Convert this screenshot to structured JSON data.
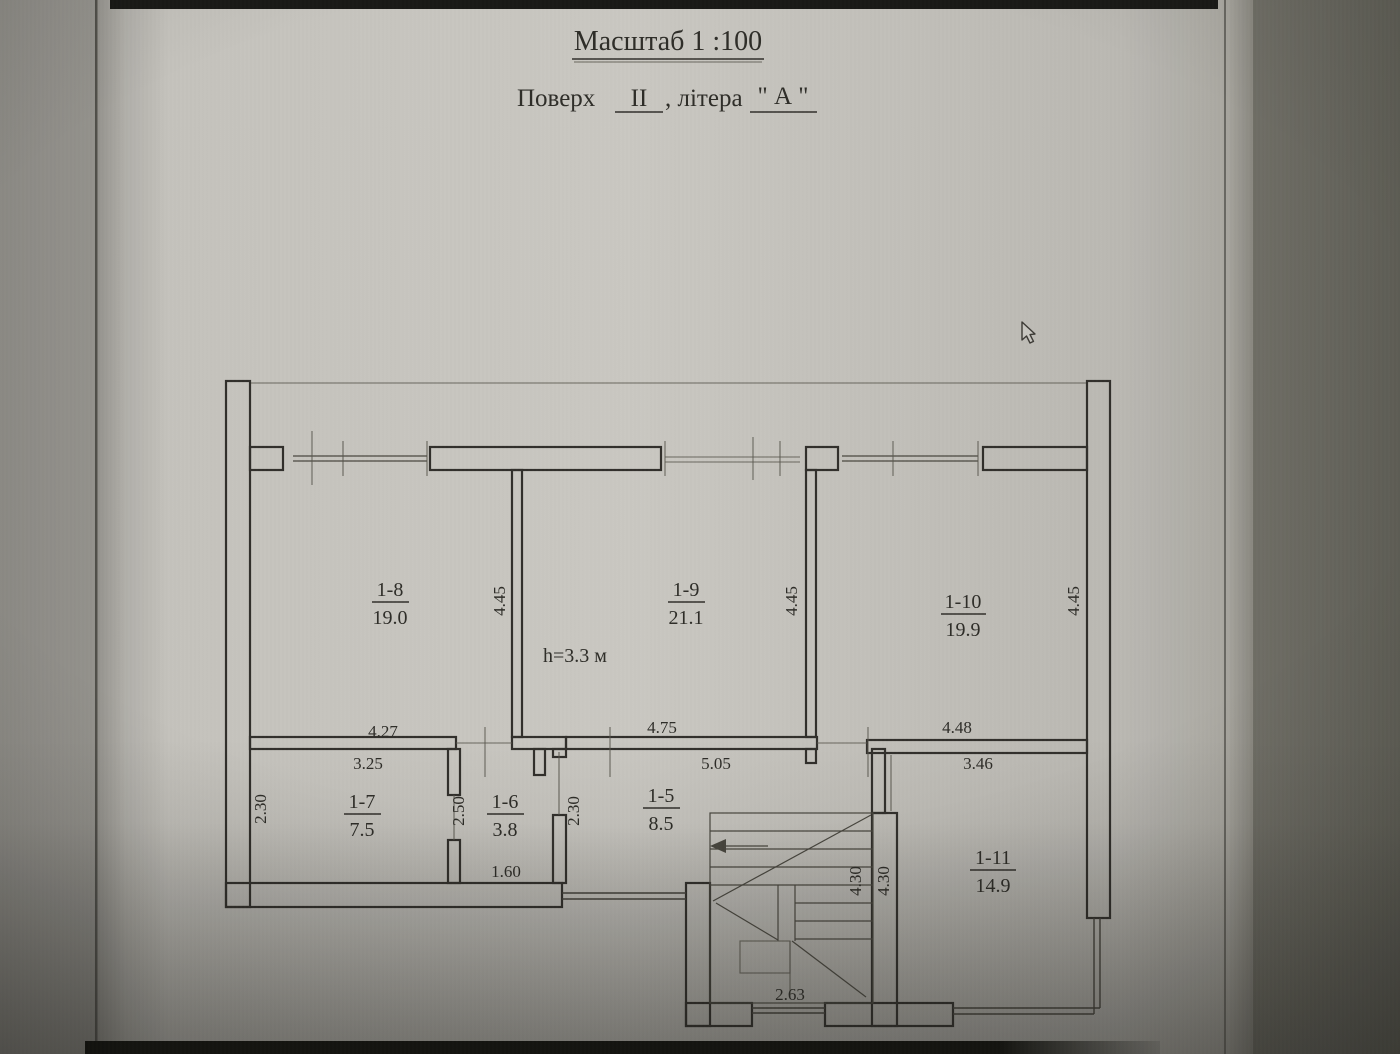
{
  "header": {
    "title": "Масштаб 1 :100",
    "floor_label": "Поверх",
    "floor_value": "ІІ",
    "separator": ", літера",
    "letter_value": "\" А \""
  },
  "plan": {
    "height_note": "h=3.3 м",
    "rooms": [
      {
        "num": "1-8",
        "area": "19.0"
      },
      {
        "num": "1-9",
        "area": "21.1"
      },
      {
        "num": "1-10",
        "area": "19.9"
      },
      {
        "num": "1-7",
        "area": "7.5"
      },
      {
        "num": "1-6",
        "area": "3.8"
      },
      {
        "num": "1-5",
        "area": "8.5"
      },
      {
        "num": "1-11",
        "area": "14.9"
      }
    ],
    "dims_horizontal": [
      {
        "v": "4.27"
      },
      {
        "v": "3.25"
      },
      {
        "v": "4.75"
      },
      {
        "v": "5.05"
      },
      {
        "v": "4.48"
      },
      {
        "v": "3.46"
      },
      {
        "v": "1.60"
      },
      {
        "v": "2.63"
      }
    ],
    "dims_vertical": [
      {
        "v": "4.45"
      },
      {
        "v": "4.45"
      },
      {
        "v": "4.45"
      },
      {
        "v": "2.30"
      },
      {
        "v": "2.50"
      },
      {
        "v": "2.30"
      },
      {
        "v": "4.30"
      },
      {
        "v": "4.30"
      }
    ]
  }
}
